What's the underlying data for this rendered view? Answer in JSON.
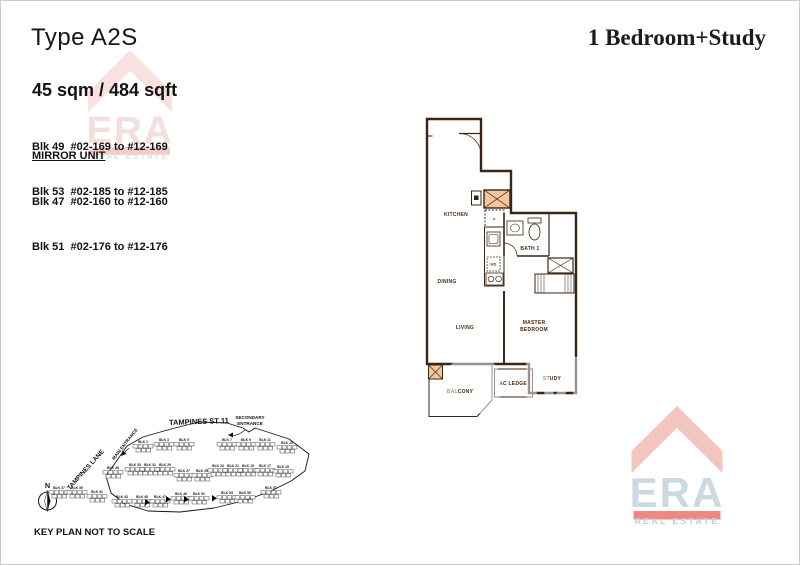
{
  "page": {
    "title_left": "Type A2S",
    "title_right": "1 Bedroom+Study"
  },
  "details": {
    "area": "45 sqm / 484 sqft",
    "blocks": [
      "Blk 49  #02-169 to #12-169",
      "Blk 53  #02-185 to #12-185"
    ],
    "mirror_label": "MIRROR UNIT",
    "mirror_blocks": [
      "Blk 47  #02-160 to #12-160",
      "Blk 51  #02-176 to #12-176"
    ]
  },
  "floorplan": {
    "fill": "#F4C69B",
    "wall": "#3A2414",
    "rooms": [
      {
        "label": "KITCHEN",
        "x": 50,
        "y": 110
      },
      {
        "label": "DINING",
        "x": 41,
        "y": 177
      },
      {
        "label": "LIVING",
        "x": 59,
        "y": 223
      },
      {
        "lines": [
          "MASTER",
          "BEDROOM"
        ],
        "x": 128,
        "y": 218
      },
      {
        "label": "BATH 1",
        "x": 124,
        "y": 144
      },
      {
        "label": "BALCONY",
        "x": 54,
        "y": 287
      },
      {
        "label": "AC LEDGE",
        "x": 107,
        "y": 279
      },
      {
        "label": "STUDY",
        "x": 146,
        "y": 274
      },
      {
        "label": "F",
        "x": 88.5,
        "y": 114.5,
        "small": true
      },
      {
        "label": "WD",
        "x": 87.5,
        "y": 159.5,
        "small": true
      }
    ]
  },
  "keyplan": {
    "street": "TAMPINES ST 11",
    "secondary_entrance": [
      "SECONDARY",
      "ENTRANCE"
    ],
    "main_entrance": "MAIN ENTRANCE",
    "lane": "TAMPINES LANE",
    "north": "N",
    "note": "KEY PLAN NOT TO SCALE",
    "blocks": [
      {
        "label": "BLK 1",
        "x": 112,
        "y": 42
      },
      {
        "label": "BLK 3",
        "x": 133,
        "y": 40
      },
      {
        "label": "BLK 5",
        "x": 153,
        "y": 40
      },
      {
        "label": "BLK 7",
        "x": 196,
        "y": 40
      },
      {
        "label": "BLK 9",
        "x": 215,
        "y": 40
      },
      {
        "label": "BLK 11",
        "x": 234,
        "y": 40
      },
      {
        "label": "BLK 13",
        "x": 256,
        "y": 43
      },
      {
        "label": "BLK 35",
        "x": 82,
        "y": 68
      },
      {
        "label": "BLK 33",
        "x": 104,
        "y": 65
      },
      {
        "label": "BLK 31",
        "x": 119,
        "y": 65
      },
      {
        "label": "BLK 29",
        "x": 134,
        "y": 65
      },
      {
        "label": "BLK 27",
        "x": 153,
        "y": 71
      },
      {
        "label": "BLK 25",
        "x": 171,
        "y": 71
      },
      {
        "label": "BLK 23",
        "x": 187,
        "y": 66
      },
      {
        "label": "BLK 21",
        "x": 202,
        "y": 66
      },
      {
        "label": "BLK 19",
        "x": 217,
        "y": 66
      },
      {
        "label": "BLK 17",
        "x": 234,
        "y": 66
      },
      {
        "label": "BLK 15",
        "x": 252,
        "y": 67
      },
      {
        "label": "BLK 37",
        "x": 28,
        "y": 88
      },
      {
        "label": "BLK 39",
        "x": 46,
        "y": 88
      },
      {
        "label": "BLK 41",
        "x": 66,
        "y": 92
      },
      {
        "label": "BLK 43",
        "x": 91,
        "y": 97
      },
      {
        "label": "BLK 45",
        "x": 111,
        "y": 97
      },
      {
        "label": "BLK 47",
        "x": 129,
        "y": 97,
        "marked": true
      },
      {
        "label": "BLK 49",
        "x": 150,
        "y": 94,
        "marked": true
      },
      {
        "label": "BLK 51",
        "x": 168,
        "y": 94,
        "marked": true
      },
      {
        "label": "BLK 53",
        "x": 196,
        "y": 93,
        "marked": true
      },
      {
        "label": "BLK 55",
        "x": 214,
        "y": 93
      },
      {
        "label": "BLK 57",
        "x": 240,
        "y": 88
      }
    ]
  },
  "watermark": {
    "brand": "ERA",
    "tagline": "REAL ESTATE",
    "overlay": "LOM",
    "chevron_color": "#F2C2BC",
    "brand_color": "#C9D7E2",
    "bar_color": "#EE837C",
    "tagline_color": "#B7C9D6"
  }
}
